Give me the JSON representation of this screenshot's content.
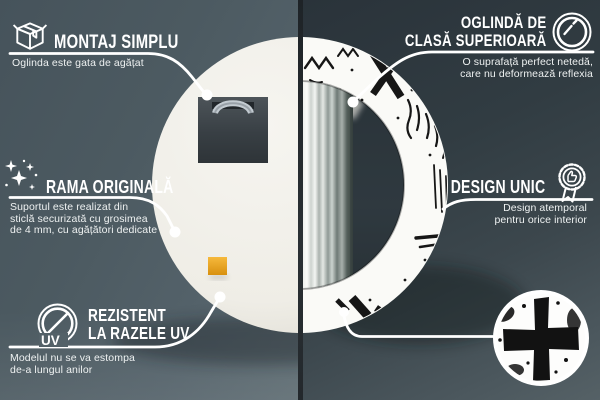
{
  "colors": {
    "background_left": "#4e5c63",
    "background_right": "#313b41",
    "callout_line": "#ffffff",
    "mounting_pad": "#eda21f",
    "pattern_ink": "#141414",
    "mirror_back": "#f0efe9"
  },
  "callouts": {
    "montaj": {
      "icon": "package-box-icon",
      "title": "MONTAJ SIMPLU",
      "description": "Oglinda este gata de agățat"
    },
    "oglinda": {
      "icon": "mirror-shine-icon",
      "title_line1": "OGLINDĂ DE",
      "title_line2": "CLASĂ SUPERIOARĂ",
      "description_line1": "O suprafață perfect netedă,",
      "description_line2": "care nu deformează reflexia"
    },
    "rama": {
      "icon": "sparkles-icon",
      "title": "RAMA ORIGINALĂ",
      "description_line1": "Suportul este realizat din",
      "description_line2": "sticlă securizată cu grosimea",
      "description_line3": "de 4 mm, cu agățători dedicate"
    },
    "design": {
      "icon": "award-badge-icon",
      "title": "DESIGN UNIC",
      "description_line1": "Design atemporal",
      "description_line2": "pentru orice interior"
    },
    "uv": {
      "icon": "uv-protection-icon",
      "icon_label": "UV",
      "title_line1": "REZISTENT",
      "title_line2": "LA RAZELE UV",
      "description_line1": "Modelul nu se va estompa",
      "description_line2": "de-a lungul anilor"
    }
  }
}
